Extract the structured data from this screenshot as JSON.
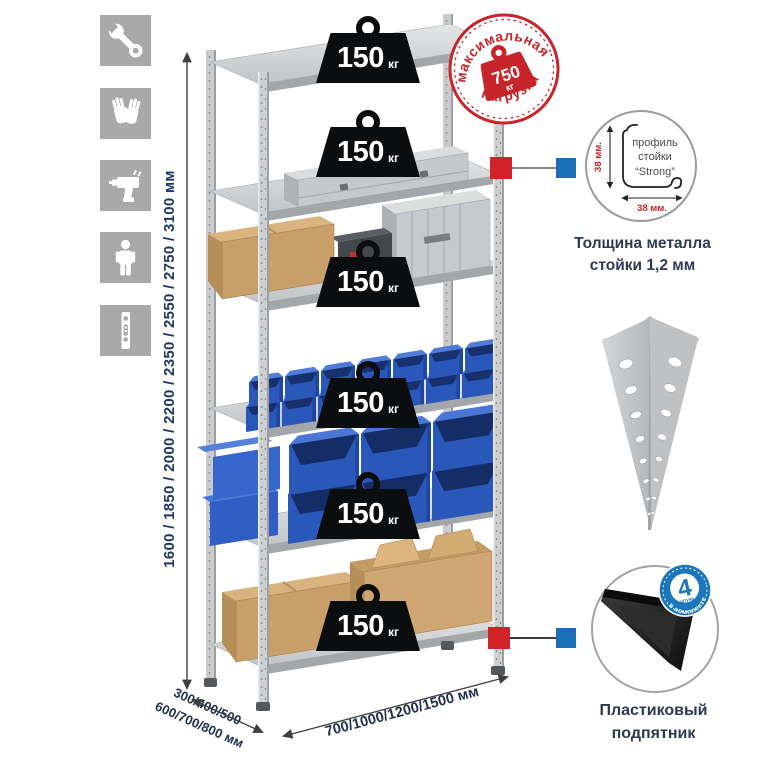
{
  "rack_dimensions": {
    "height_options": "1600 / 1850 / 2000 / 2200 / 2350 / 2550 / 2750 / 3100 мм",
    "depth_options_line1": "300/400/500",
    "depth_options_line2": "600/700/800 мм",
    "width_options": "700/1000/1200/1500 мм"
  },
  "shelf_load": {
    "value": "150",
    "unit": "кг"
  },
  "max_load_stamp": {
    "arc_top": "максимальная",
    "arc_bottom": "нагрузка",
    "value": "750",
    "unit": "кг"
  },
  "profile_detail": {
    "label_line1": "профиль",
    "label_line2": "стойки",
    "label_line3": "“Strong”",
    "height_dim": "38 мм.",
    "width_dim": "38 мм.",
    "caption_line1": "Толщина металла",
    "caption_line2": "стойки 1,2 мм"
  },
  "foot_detail": {
    "badge_value": "4",
    "badge_unit": "штуки",
    "badge_arc": "в комплекте",
    "caption_line1": "Пластиковый",
    "caption_line2": "подпятник"
  },
  "side_icons": [
    "wrench-icon",
    "gloves-icon",
    "drill-icon",
    "person-icon",
    "shelf-post-icon"
  ],
  "colors": {
    "stamp_red": "#c8252b",
    "marker_red": "#d2232a",
    "marker_blue": "#1b6fb8",
    "bin_blue": "#2a58ba",
    "icon_gray": "#a9a9a9",
    "text_navy": "#1e3765"
  }
}
